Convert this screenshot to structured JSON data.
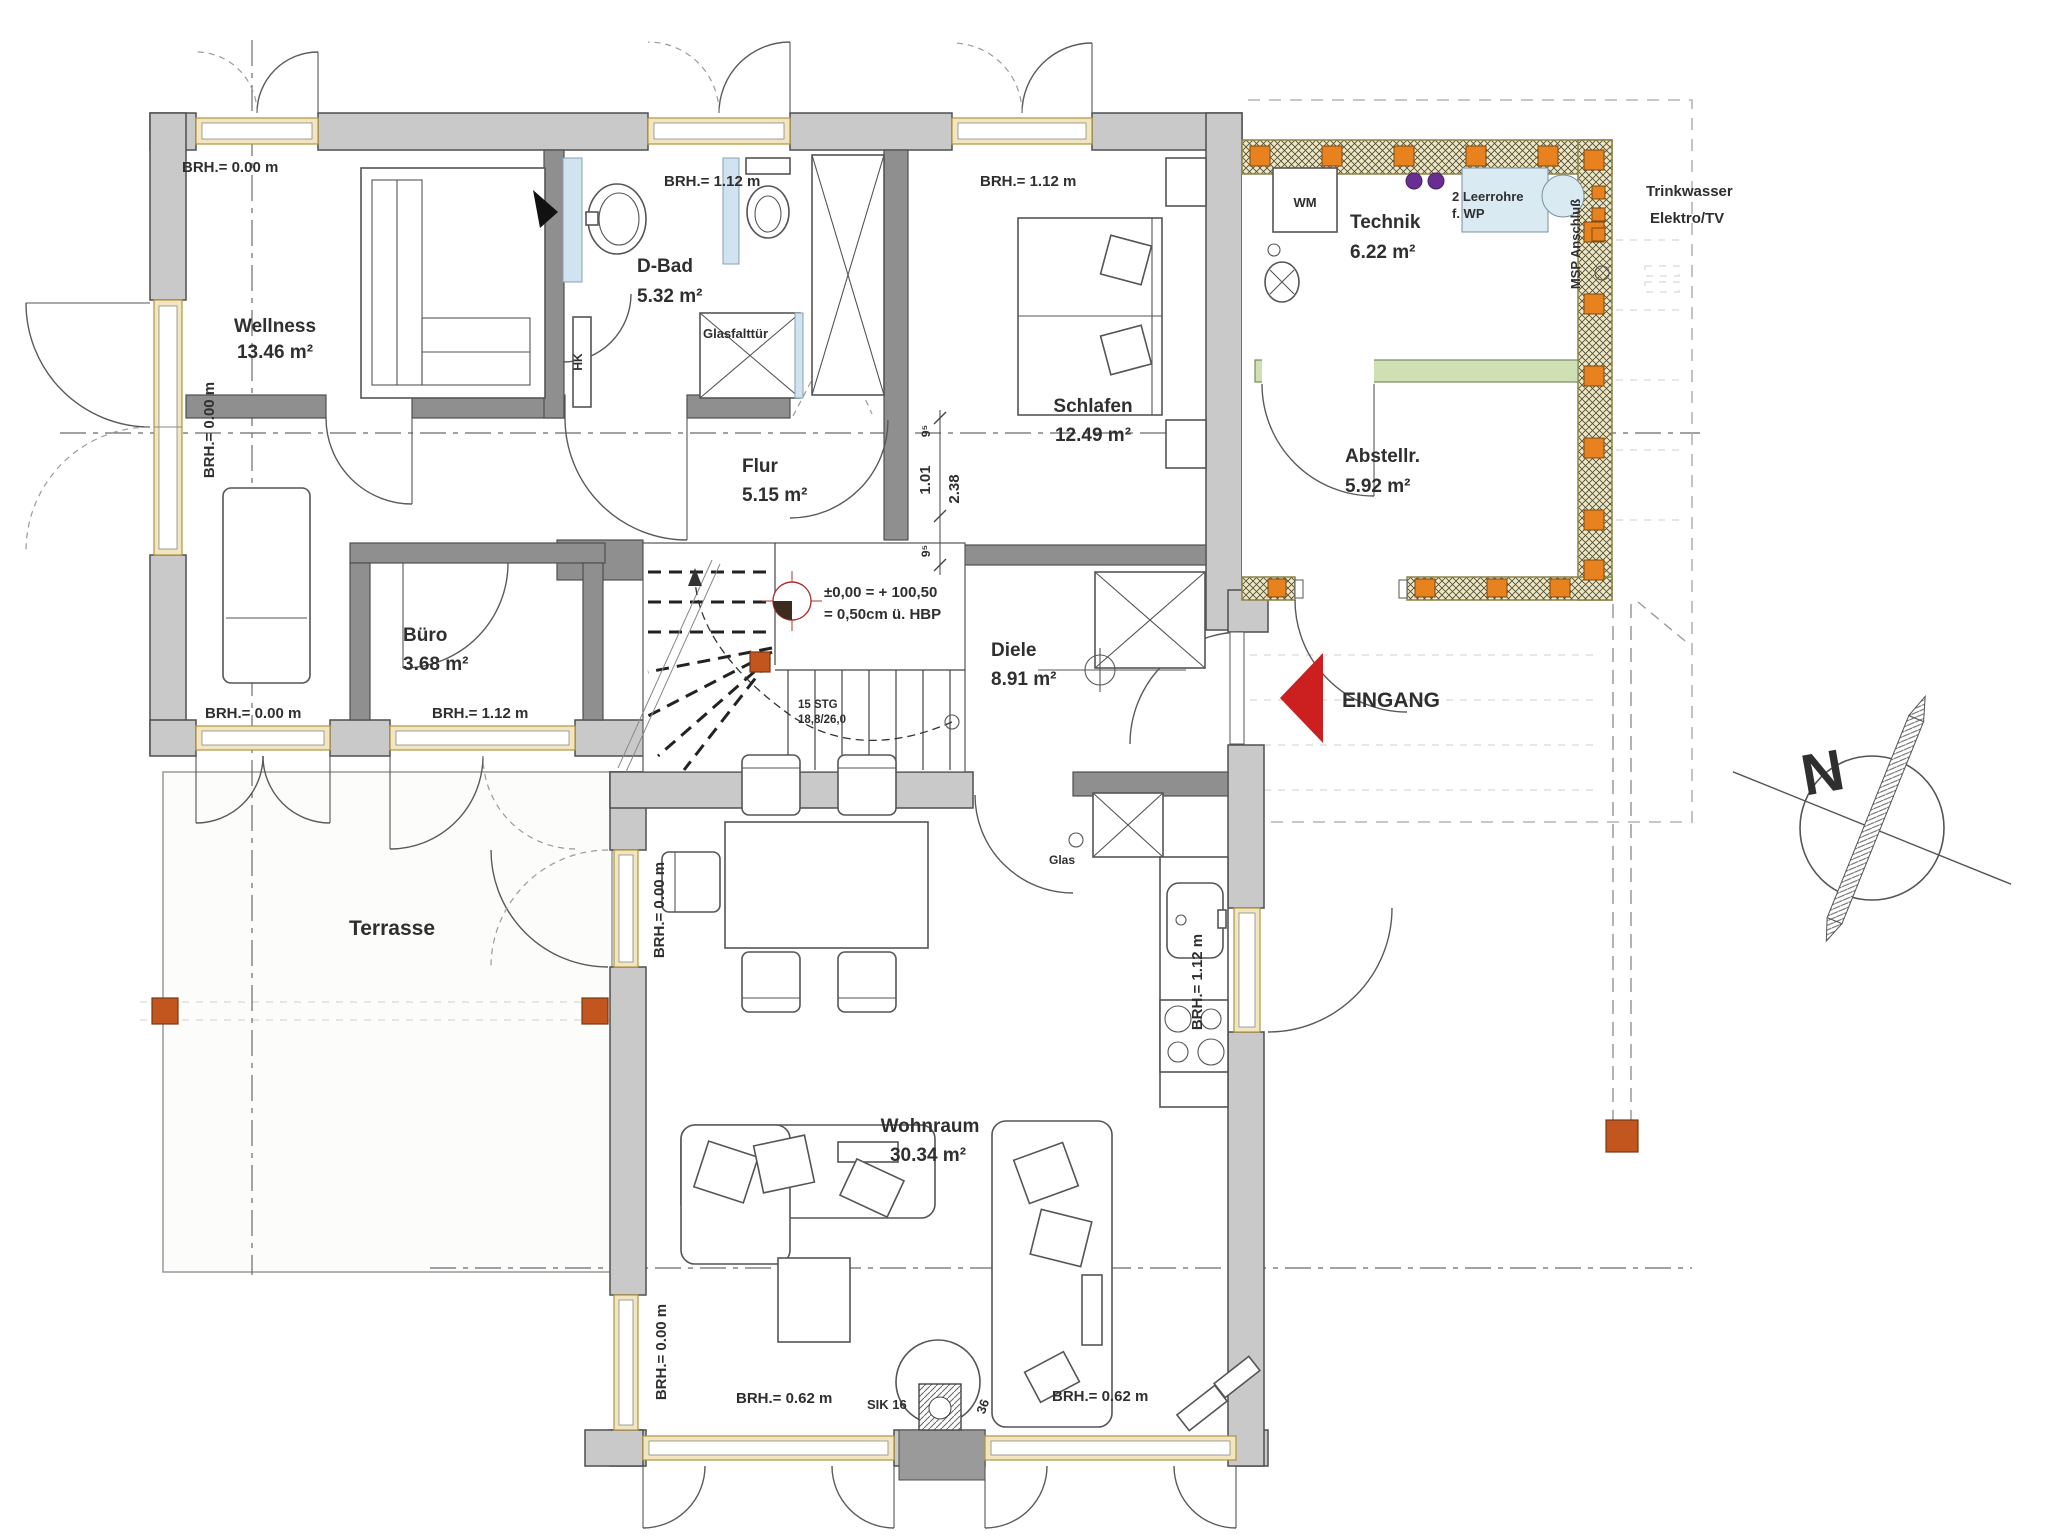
{
  "plan_type": "architectural floor plan (Erdgeschoss)",
  "rooms": [
    {
      "name": "Wellness",
      "area": "13.46 m²"
    },
    {
      "name": "D-Bad",
      "area": "5.32 m²"
    },
    {
      "name": "Schlafen",
      "area": "12.49 m²"
    },
    {
      "name": "Flur",
      "area": "5.15 m²"
    },
    {
      "name": "Büro",
      "area": "3.68 m²"
    },
    {
      "name": "Diele",
      "area": "8.91 m²"
    },
    {
      "name": "Technik",
      "area": "6.22 m²"
    },
    {
      "name": "Abstellr.",
      "area": "5.92 m²"
    },
    {
      "name": "Wohnraum",
      "area": "30.34 m²"
    },
    {
      "name": "Terrasse",
      "area": ""
    }
  ],
  "sills": {
    "brh_000": "BRH.= 0.00 m",
    "brh_112": "BRH.= 1.12 m",
    "brh_062": "BRH.= 0.62 m"
  },
  "entrance_label": "EINGANG",
  "compass_label": "N",
  "stair_note": {
    "line1": "15 STG",
    "line2": "18,8/26,0"
  },
  "level_note": {
    "line1": "±0,00 = + 100,50",
    "line2": "= 0,50cm ü. HBP"
  },
  "dims": {
    "top": "9⁵",
    "mid_left": "1.01",
    "mid_right": "2.38",
    "bottom": "9⁵"
  },
  "tech_room": {
    "wm": "WM",
    "pipes_line1": "2 Leerrohre",
    "pipes_line2": "f. WP",
    "msp": "MSP Anschluß",
    "water": "Trinkwasser",
    "electric": "Elektro/TV"
  },
  "fixtures": {
    "radiator": "HK",
    "shower_door": "Glasfalttür",
    "glass_door": "Glas",
    "chimney": "SIK 16",
    "chimney_dim": "36"
  },
  "colors": {
    "entrance_arrow": "#cc2020",
    "water_text": "#35b6c0",
    "electric_text": "#d85050",
    "level_text": "#cc3333",
    "shower_text": "#45b0d8",
    "post": "#c2561e",
    "stud": "#e8821e",
    "sill_green": "#cfe0b4",
    "pipe_purple": "#6a2d91"
  }
}
